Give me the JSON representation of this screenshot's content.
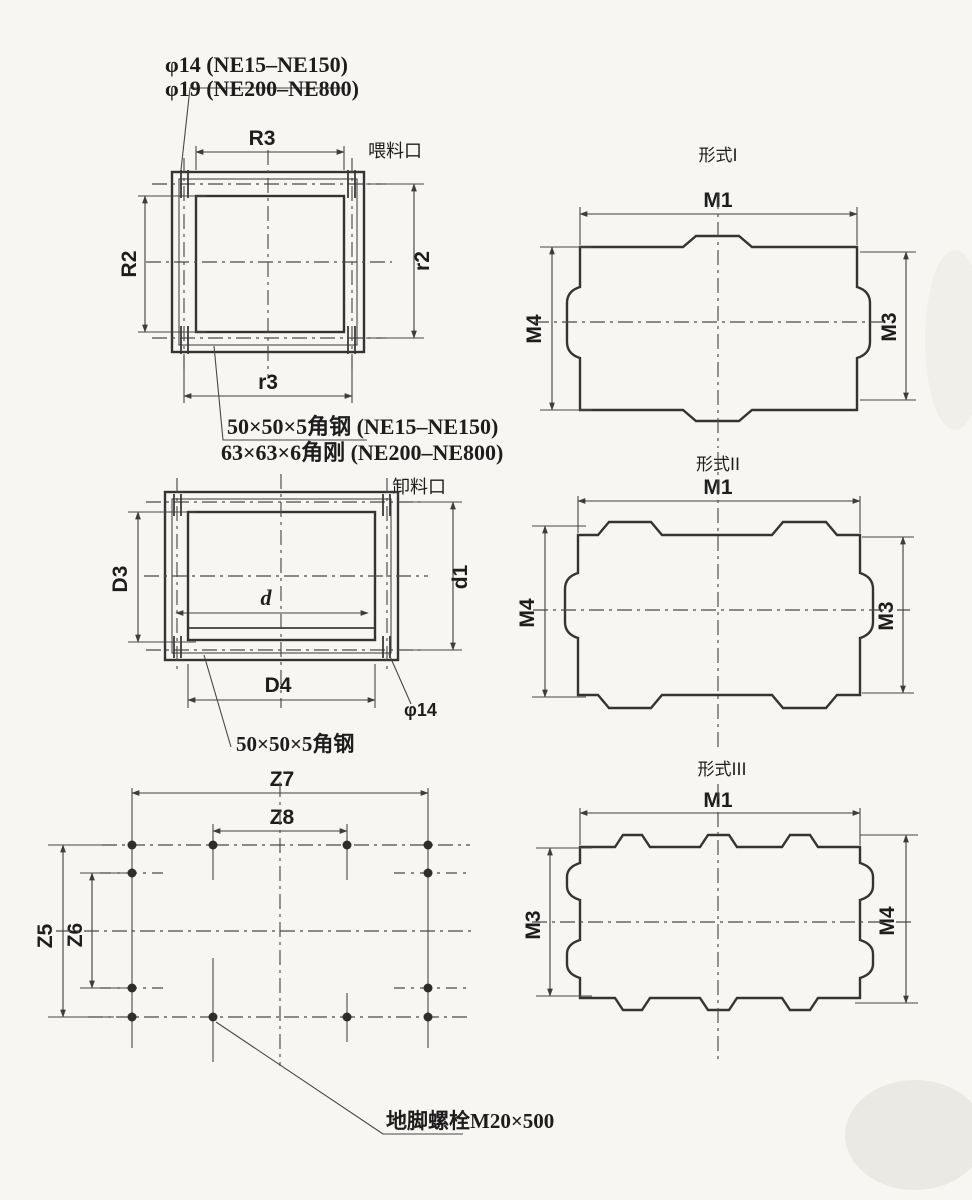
{
  "canvas": {
    "background": "#f7f6f2",
    "ink": "#343434"
  },
  "feed_inlet": {
    "view_label": "喂料口",
    "hole_note_line1": "φ14 (NE15–NE150)",
    "hole_note_line2": "φ19 (NE200–NE800)",
    "angle_note_line1": "50×50×5角钢 (NE15–NE150)",
    "angle_note_line2": "63×63×6角刚 (NE200–NE800)",
    "dim_top": "R3",
    "dim_left": "R2",
    "dim_right": "r2",
    "dim_bottom": "r3"
  },
  "discharge_outlet": {
    "view_label": "卸料口",
    "dim_left": "D3",
    "dim_right": "d1",
    "dim_bottom": "D4",
    "dim_inner": "d",
    "hole_note": "φ14",
    "angle_note": "50×50×5角钢"
  },
  "anchor_plan": {
    "dim_outer_width": "Z7",
    "dim_inner_width": "Z8",
    "dim_outer_height": "Z5",
    "dim_inner_height": "Z6",
    "bolt_note": "地脚螺栓M20×500"
  },
  "forms": [
    {
      "title": "形式I",
      "dim_width": "M1",
      "dim_left": "M4",
      "dim_right": "M3"
    },
    {
      "title": "形式II",
      "dim_width": "M1",
      "dim_left": "M4",
      "dim_right": "M3"
    },
    {
      "title": "形式III",
      "dim_width": "M1",
      "dim_left": "M3",
      "dim_right": "M4"
    }
  ]
}
